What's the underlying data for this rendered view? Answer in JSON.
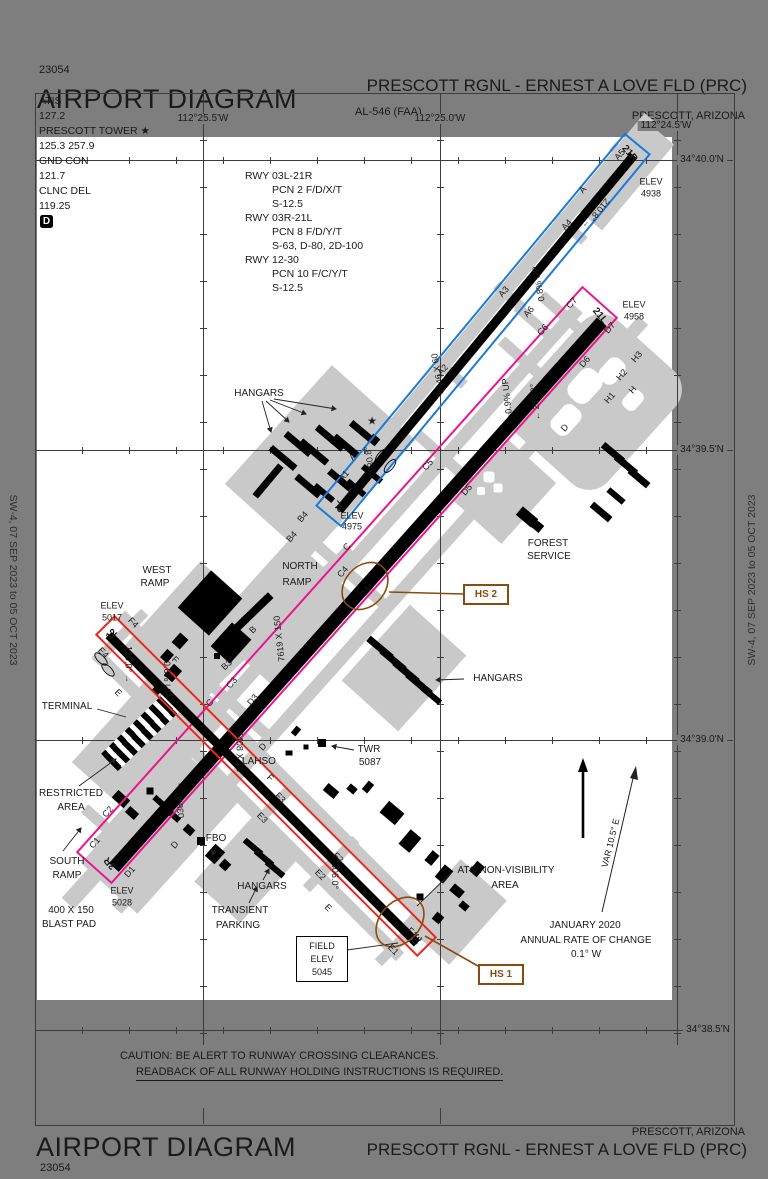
{
  "edition": "SW-4,  07 SEP 2023  to  05 OCT 2023",
  "header": {
    "code": "23054",
    "title": "AIRPORT DIAGRAM",
    "al": "AL-546 (FAA)",
    "airport": "PRESCOTT RGNL - ERNEST A LOVE FLD (PRC)",
    "city": "PRESCOTT, ARIZONA"
  },
  "footer": {
    "code": "23054",
    "title": "AIRPORT DIAGRAM",
    "airport": "PRESCOTT RGNL - ERNEST A LOVE FLD (PRC)",
    "city": "PRESCOTT, ARIZONA",
    "caution1": "CAUTION: BE ALERT TO RUNWAY CROSSING CLEARANCES.",
    "caution2": "READBACK OF ALL RUNWAY HOLDING INSTRUCTIONS IS REQUIRED."
  },
  "comms": {
    "atis": "ATIS",
    "atis_f": "127.2",
    "twr": "PRESCOTT TOWER ★",
    "twr_f": "125.3  257.9",
    "gnd": "GND CON",
    "gnd_f": "121.7",
    "clnc": "CLNC DEL",
    "clnc_f": "119.25"
  },
  "rwy_info": [
    "RWY 03L-21R",
    "PCN 2 F/D/X/T",
    "S-12.5",
    "RWY 03R-21L",
    "PCN 8 F/D/Y/T",
    "S-63, D-80, 2D-100",
    "RWY 12-30",
    "PCN 10 F/C/Y/T",
    "S-12.5"
  ],
  "grid": {
    "lon": [
      "112°25.5'W",
      "112°25.0'W",
      "112°24.5'W"
    ],
    "lat": [
      "34°40.0'N",
      "34°39.5'N",
      "34°39.0'N",
      "34°38.5'N"
    ]
  },
  "rwy03l21r": {
    "low": "3L",
    "high": "21R",
    "dim": "4846 X 60",
    "hdg_low": "030.8°",
    "hdg_high": "210.8°",
    "slope": "0.8% UP"
  },
  "rwy03r21l": {
    "low": "3R",
    "high": "21L",
    "dim": "7619 X 150",
    "hdg_low": "038.8°",
    "hdg_high": "210.8°",
    "slope": "0.9% UP"
  },
  "rwy1230": {
    "low": "12",
    "high": "30",
    "dim": "4408 X 75",
    "hdg_low": "120.0°",
    "hdg_high": "306.0°",
    "slope": "0.6% UP"
  },
  "elev": {
    "label": "ELEV",
    "e21r": "4938",
    "e21l": "4958",
    "e3l": "4975",
    "e12": "5017",
    "e3r": "5028",
    "field1": "FIELD",
    "field2": "ELEV",
    "field3": "5045"
  },
  "twy": {
    "a": "A",
    "a1": "A1",
    "a2": "A2",
    "a3": "A3",
    "a4": "A4",
    "a5": "A5",
    "a6": "A6",
    "b": "B",
    "b3": "B3",
    "b4": "B4",
    "c": "C",
    "c1": "C1",
    "c2": "C2",
    "c3": "C3",
    "c4": "C4",
    "c5": "C5",
    "c6": "C6",
    "c7": "C7",
    "d": "D",
    "d1": "D1",
    "d3": "D3",
    "d4": "D4",
    "d5": "D5",
    "d6": "D6",
    "d7": "D7",
    "e": "E",
    "e1": "E1",
    "e2": "E2",
    "e3": "E3",
    "e4": "E4",
    "f": "F",
    "f1": "F1",
    "f2": "F2",
    "f3": "F3",
    "f4": "F4",
    "h": "H",
    "h1": "H1",
    "h2": "H2",
    "h3": "H3"
  },
  "sites": {
    "hangars": "HANGARS",
    "west": "WEST",
    "north": "NORTH",
    "south": "SOUTH",
    "ramp": "RAMP",
    "terminal": "TERMINAL",
    "restricted": "RESTRICTED",
    "area": "AREA",
    "fbo": "FBO",
    "transient": "TRANSIENT",
    "parking": "PARKING",
    "forest": "FOREST",
    "service": "SERVICE",
    "twr": "TWR",
    "twr_elev": "5087",
    "lahso": "LAHSO",
    "blast1": "400 X 150",
    "blast2": "BLAST PAD"
  },
  "notes": {
    "atc1": "ATC NON-VISIBILITY",
    "atc2": "AREA",
    "jan1": "JANUARY 2020",
    "jan2": "ANNUAL RATE OF CHANGE",
    "jan3": "0.1° W",
    "var": "VAR 10.5° E"
  },
  "hotspots": {
    "hs1": "HS 1",
    "hs2": "HS 2"
  },
  "arrows": {
    "r": "→",
    "l": "←"
  },
  "symbols": {
    "star": "★",
    "d": "D"
  }
}
